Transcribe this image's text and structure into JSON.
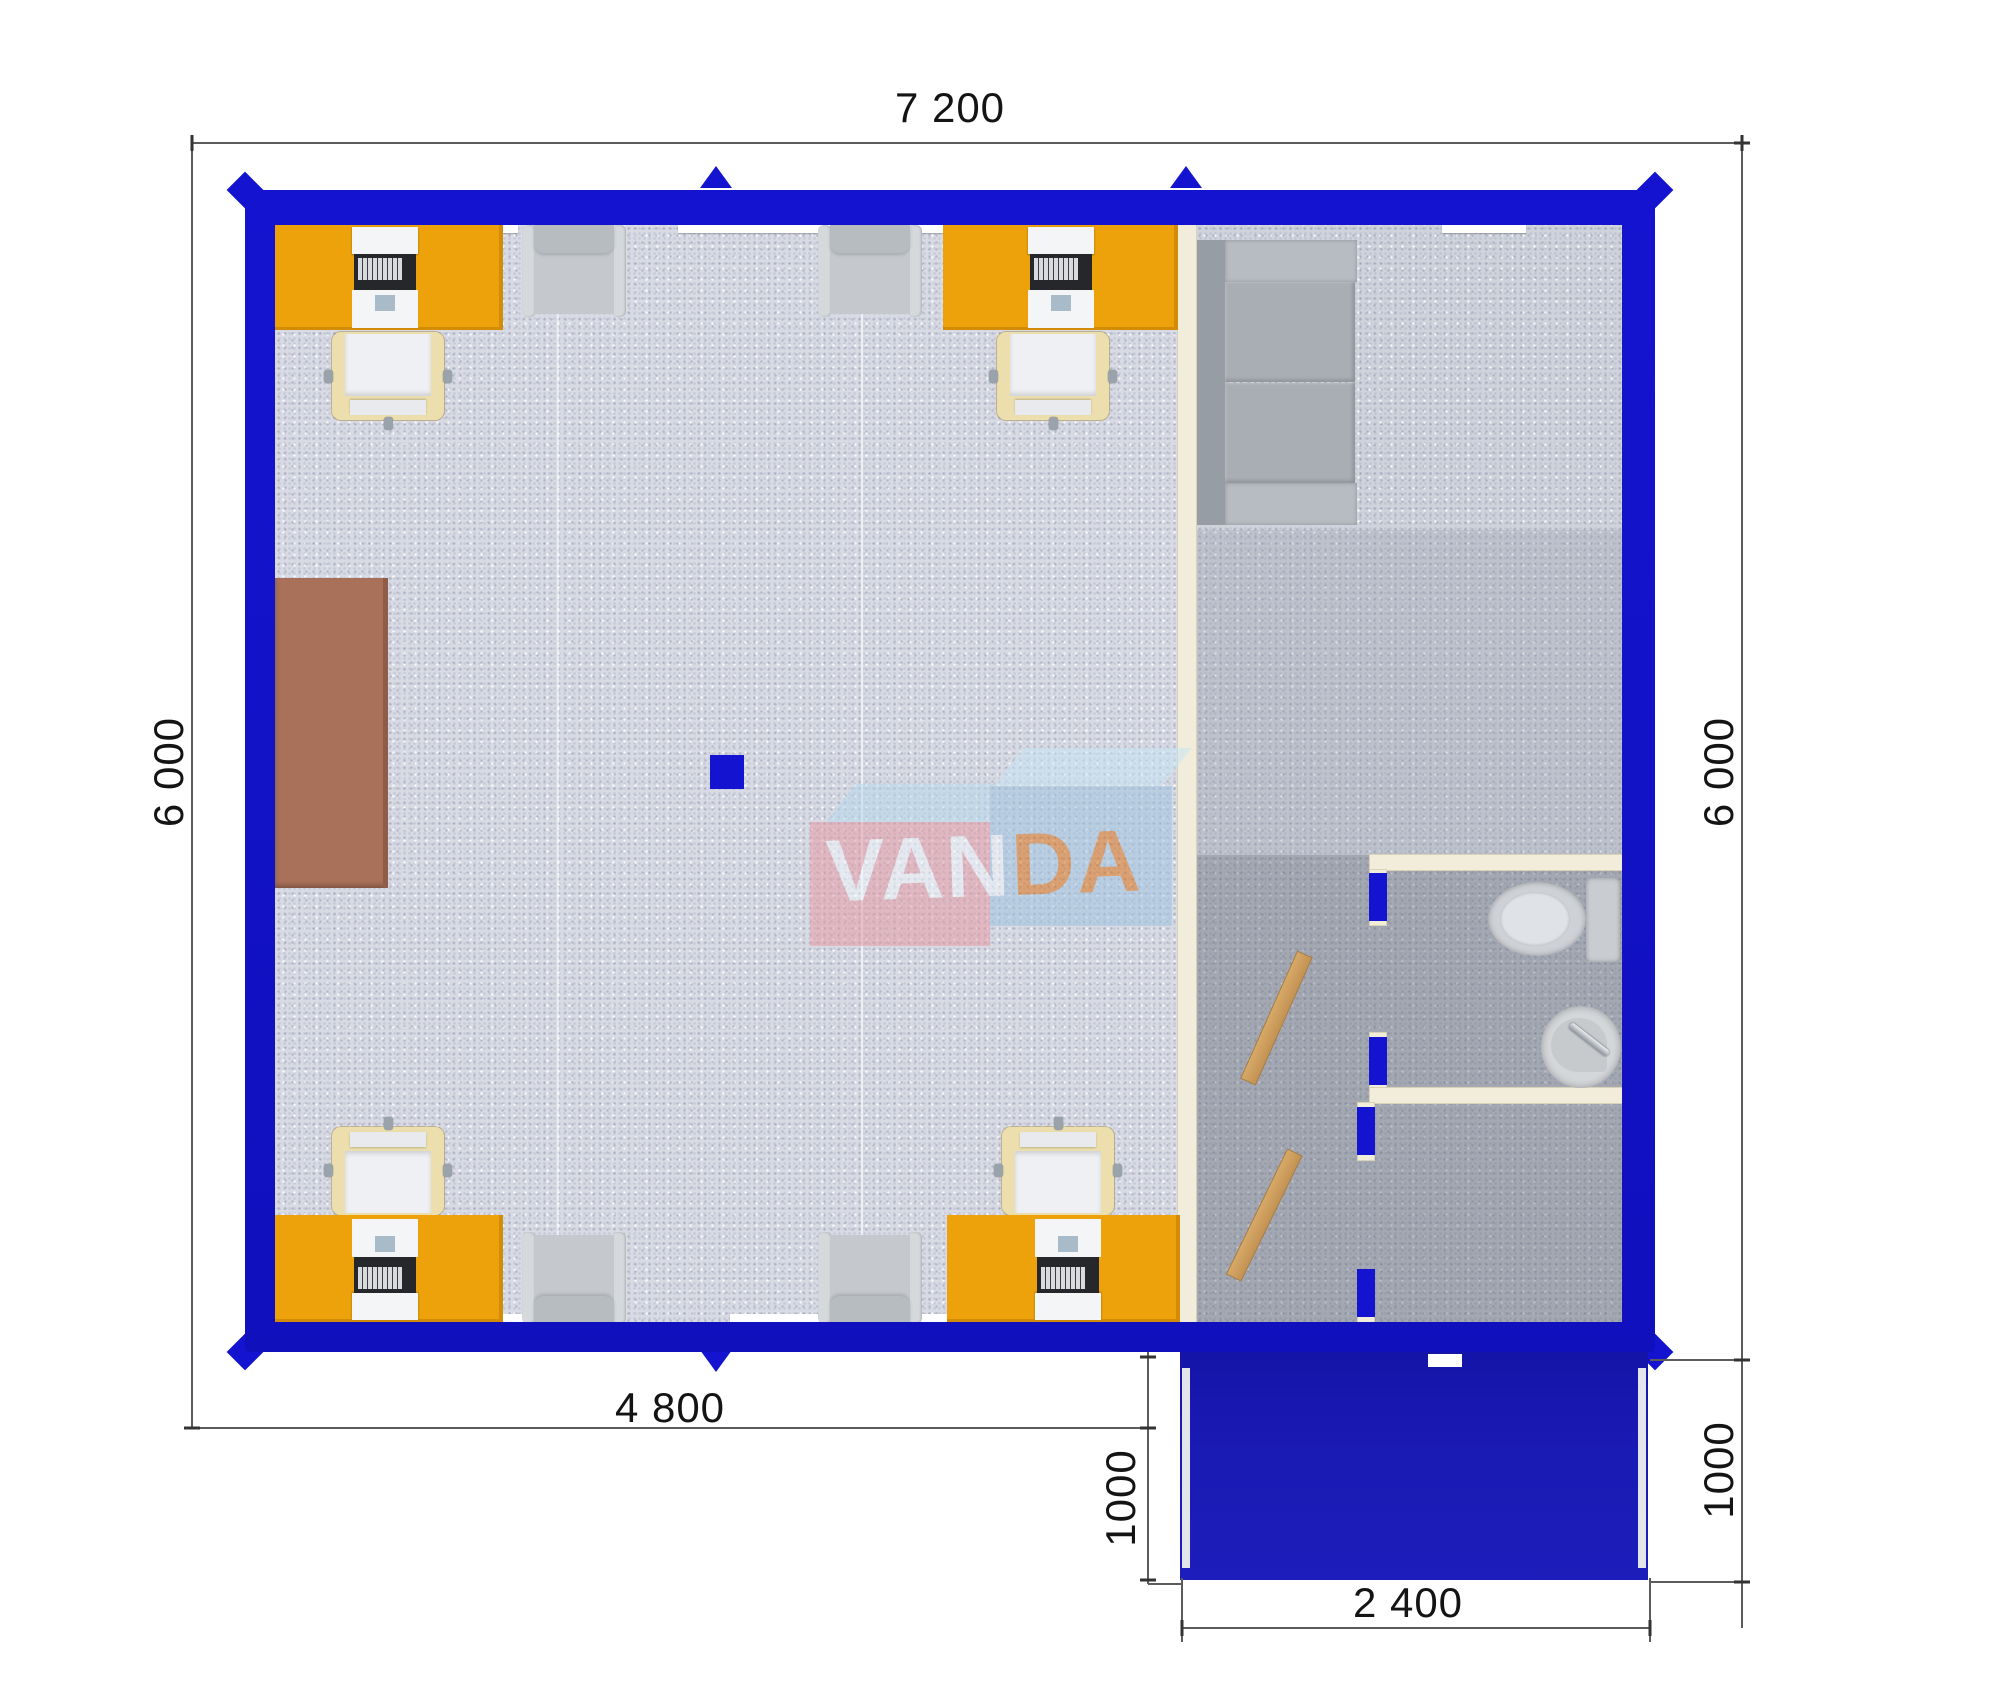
{
  "page": {
    "description": "Top-down 3D floor plan of a VANDA modular office container with porch",
    "background": "#ffffff"
  },
  "watermark": {
    "text_left": "VAN",
    "text_right": "DA"
  },
  "dimensions": {
    "top_width": "7 200",
    "left_height": "6 000",
    "right_height": "6 000",
    "bottom_left_width": "4 800",
    "porch_left_depth": "1000",
    "porch_right_depth": "1000",
    "porch_width": "2 400"
  },
  "furniture_counts": {
    "orange_desks": 4,
    "laptops": 4,
    "office_chairs": 4,
    "armchairs": 4,
    "sofa": 1,
    "brown_cabinet": 1,
    "toilet": 1,
    "sink": 1,
    "open_wood_doors": 2
  },
  "colors": {
    "wall-blue": "#1414d0",
    "wall-navy": "#2b2d7e",
    "porch-blue": "#1919b2",
    "floor-light": "#d9dbe4",
    "floor-mid": "#cfd3dc",
    "floor-dark": "#aaadb6",
    "cream": "#f2edda",
    "cream-edge": "#d8d2b6",
    "desk-orange": "#eda20b",
    "cabinet-brown": "#a9715a",
    "cabinet-brown-dark": "#8f5c47",
    "wood": "#d7a967",
    "wood-dark": "#aa7b3e",
    "sofa-seat": "#a9aeb5",
    "sofa-arm": "#b7bcc2",
    "sofa-back": "#979da5",
    "armchair": "#c5c9ce",
    "armchair-arm": "#d6d9dc",
    "chair-cream": "#ecdfad",
    "white": "#f4f5f7",
    "metal": "#9aa2ab",
    "keyboard-dark": "#26272b",
    "key-gray": "#d8dade",
    "touchpad": "#a9bac9",
    "dim-line": "#5c5c5c",
    "dim-text": "#141414",
    "logo-pink": "#e699a3",
    "logo-blue": "#9fc3e2",
    "logo-top1": "#b6d9ee",
    "logo-top2": "#c6e5f5",
    "logo-text": "#f2f7fb",
    "logo-text2": "#dc6e0f"
  }
}
